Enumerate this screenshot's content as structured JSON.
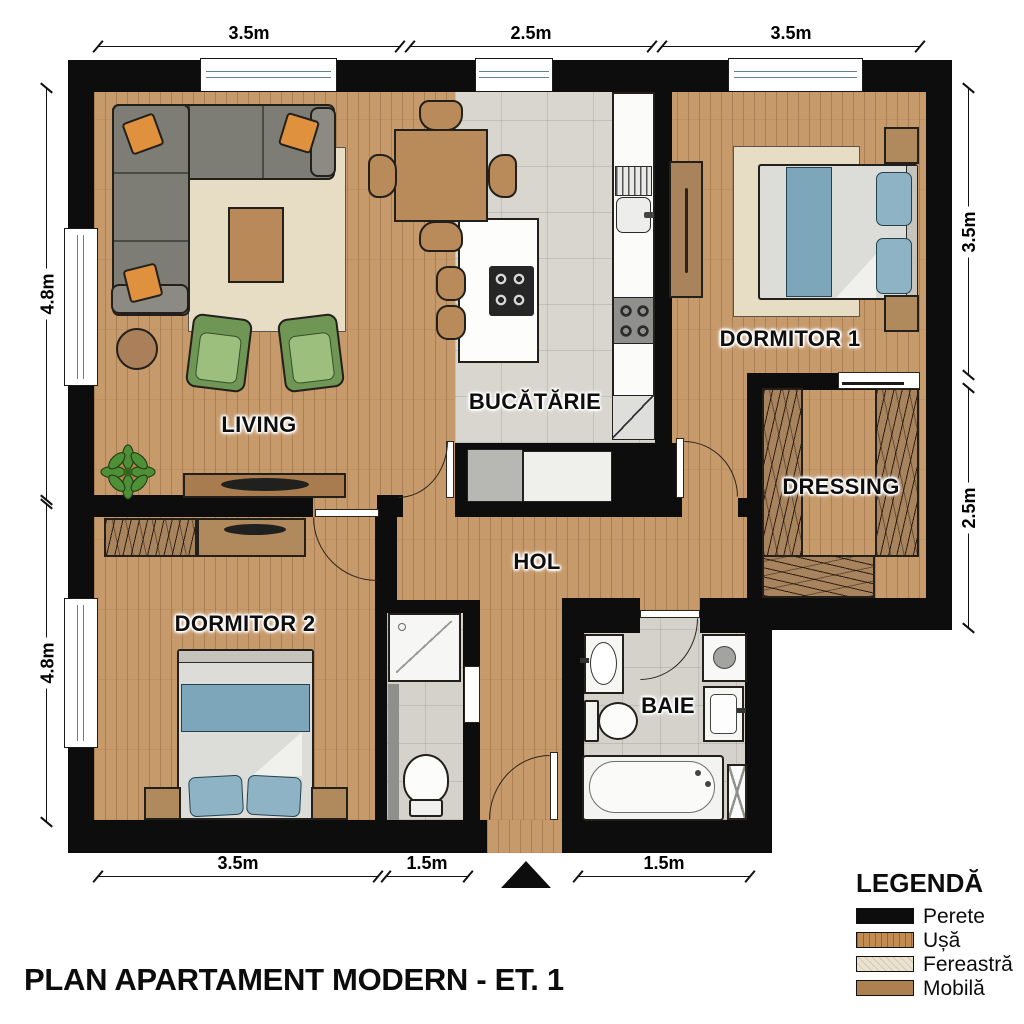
{
  "title": "PLAN APARTAMENT MODERN - ET. 1",
  "rooms": {
    "living": "LIVING",
    "kitchen": "BUCĂTĂRIE",
    "hall": "HOL",
    "bedroom1": "DORMITOR 1",
    "bedroom2": "DORMITOR 2",
    "dressing": "DRESSING",
    "bathroom": "BAIE"
  },
  "dims": {
    "top": [
      "3.5m",
      "2.5m",
      "3.5m"
    ],
    "left": [
      "4.8m",
      "4.8m"
    ],
    "right": [
      "3.5m",
      "2.5m"
    ],
    "bottom": [
      "3.5m",
      "1.5m",
      "1.5m"
    ]
  },
  "legend": {
    "title": "LEGENDĂ",
    "items": [
      {
        "label": "Perete",
        "color": "#0d0d0d"
      },
      {
        "label": "Ușă",
        "color": "#c08c52"
      },
      {
        "label": "Fereastră",
        "color": "#eae2cf"
      },
      {
        "label": "Mobilă",
        "color": "#ad8051"
      }
    ]
  },
  "colors": {
    "wall": "#0d0d0d",
    "wood_floor": "#c79a6b",
    "kitchen_tile": "#d9d6d0",
    "bath_tile": "#d5d2cc",
    "furniture_brown": "#b08a5c",
    "sofa_gray": "#7d7d76",
    "pillow_orange": "#e0913e",
    "armchair_green": "#87aa6b",
    "bed_blue": "#7ea6ba",
    "rug_beige": "#e7ddc4"
  }
}
